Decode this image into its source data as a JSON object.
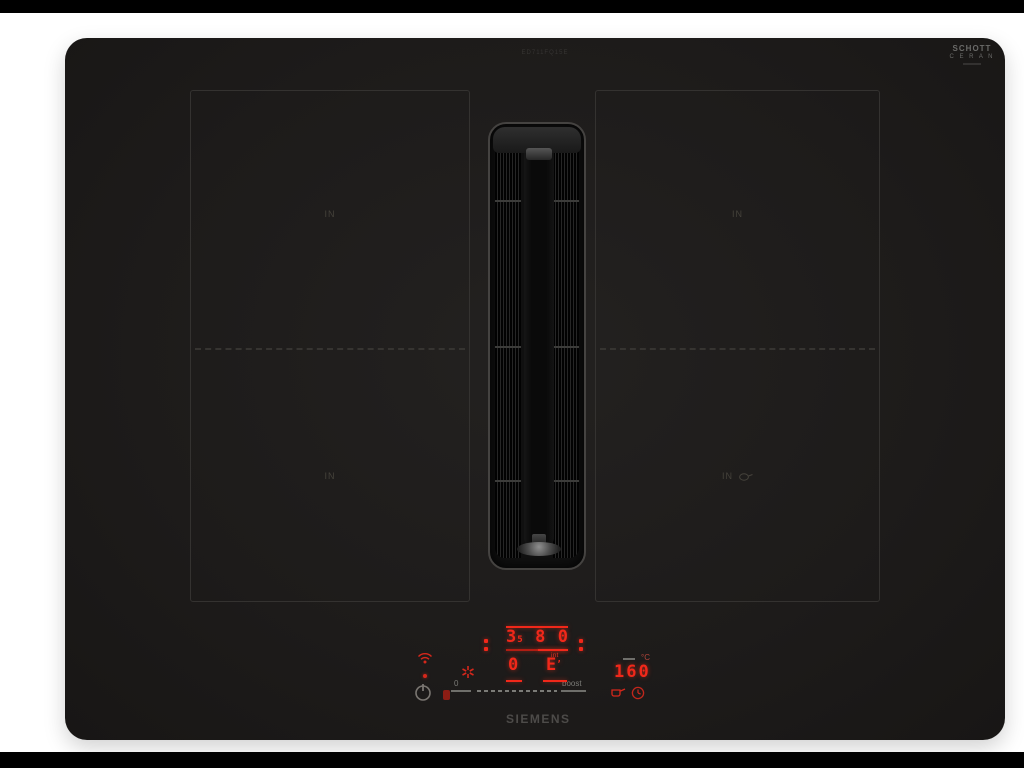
{
  "photo": {
    "background_color": "#ffffff",
    "letterbox_color": "#000000"
  },
  "hob": {
    "brand": "SIEMENS",
    "model_etching": "ED711FQ15E",
    "glass_brand": {
      "line1": "SCHOTT",
      "line2": "C E R A N"
    },
    "glass_color": "#1d1b1a",
    "zones": {
      "top_left_label": "IN",
      "top_right_label": "IN",
      "bottom_left_label": "IN",
      "bottom_right_label": "IN"
    }
  },
  "control_panel": {
    "power_display": {
      "digit_left": "3",
      "digit_left_sub": "5",
      "digit_mid": "8",
      "digit_right": "0"
    },
    "vent_display": {
      "left_value": "0",
      "right_value": "E",
      "right_mark": "’",
      "mode_label": "int"
    },
    "temp_display": {
      "value": "160",
      "unit": "°C"
    },
    "slider": {
      "min_label": "0",
      "max_label": "boost"
    },
    "icons": {
      "wifi": "home-connect-wifi",
      "power": "power-on-off",
      "lock": "child-lock",
      "star": "quick-select-star",
      "pan": "frying-sensor-pan",
      "clock": "timer-clock"
    },
    "led_color": "#f1281a",
    "print_color": "#7b7b77"
  }
}
